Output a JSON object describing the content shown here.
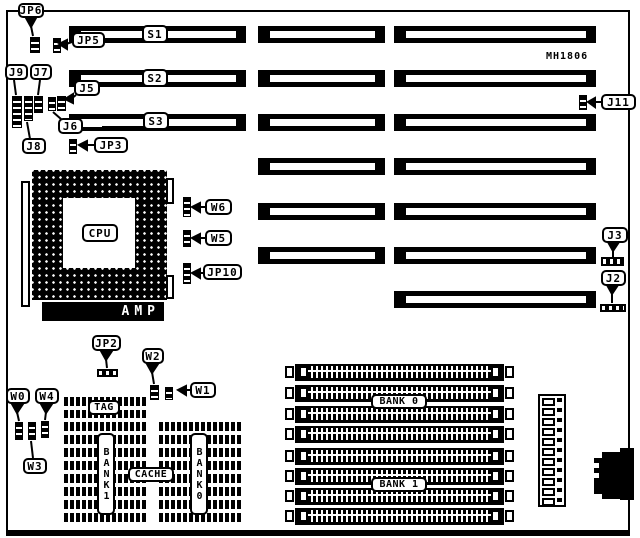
{
  "board": {
    "model": "MH1806"
  },
  "slots": {
    "s1": "S1",
    "s2": "S2",
    "s3": "S3"
  },
  "cpu": {
    "label": "CPU",
    "socket_brand": "AMP"
  },
  "jumpers": {
    "jp6": "JP6",
    "jp5": "JP5",
    "j9": "J9",
    "j7": "J7",
    "j5": "J5",
    "j6": "J6",
    "j8": "J8",
    "jp3": "JP3",
    "j11": "J11",
    "j3": "J3",
    "j2": "J2",
    "w6": "W6",
    "w5": "W5",
    "jp10": "JP10",
    "jp2": "JP2",
    "w2": "W2",
    "w1": "W1",
    "w0": "W0",
    "w4": "W4",
    "w3": "W3"
  },
  "cache": {
    "tag": "TAG",
    "cache": "CACHE",
    "bank0": "BANK0",
    "bank1": "BANK1"
  },
  "memory": {
    "bank0": "BANK 0",
    "bank1": "BANK 1"
  },
  "colors": {
    "ink": "#000000",
    "paper": "#ffffff"
  }
}
